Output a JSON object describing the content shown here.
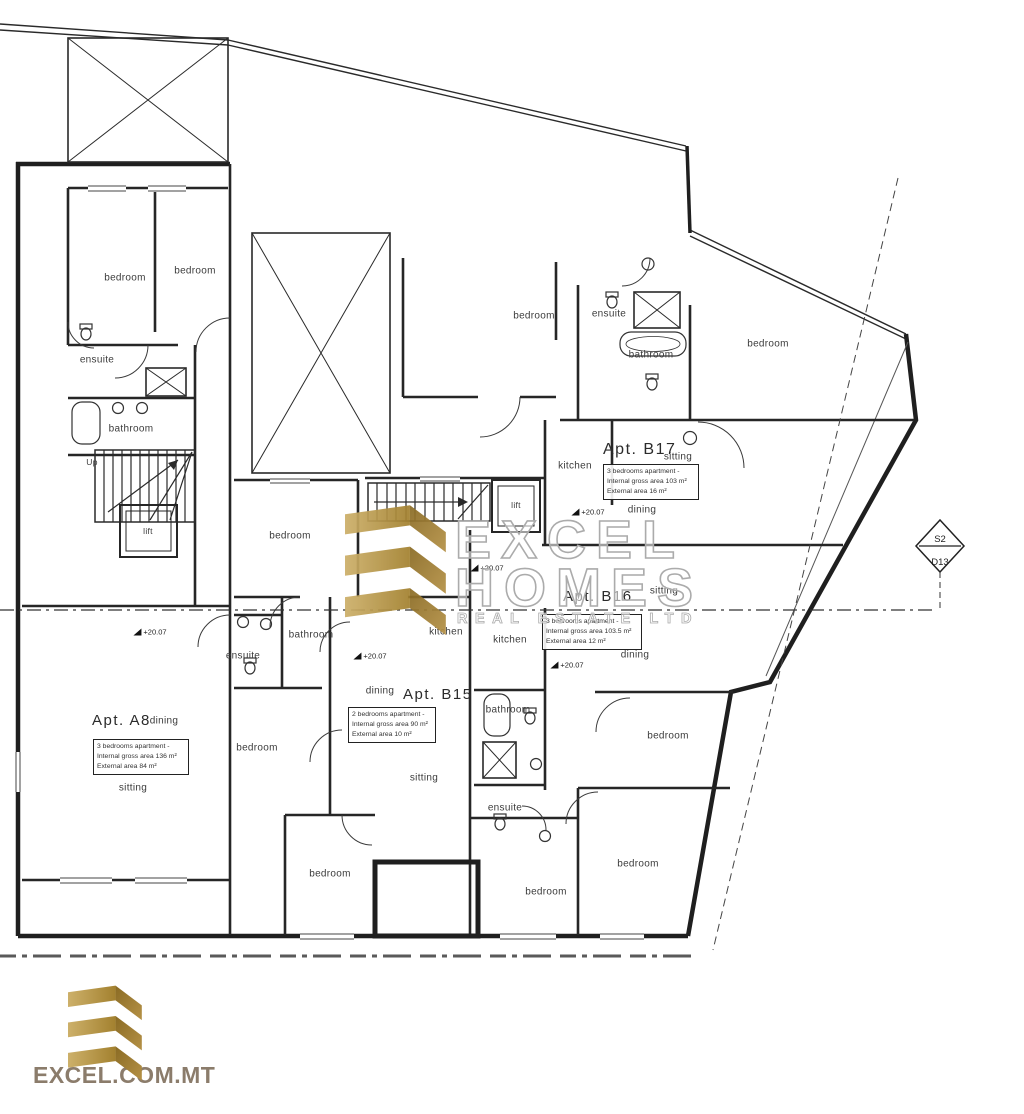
{
  "watermark": {
    "line1": "EXCEL",
    "line2": "HOMES",
    "line3": "REAL ESTATE LTD"
  },
  "footer": {
    "website": "EXCEL.COM.MT"
  },
  "plan": {
    "rooms": {
      "bedroom": "bedroom",
      "bathroom": "bathroom",
      "ensuite": "ensuite",
      "kitchen": "kitchen",
      "dining": "dining",
      "sitting": "sitting",
      "lift": "lift",
      "up": "Up"
    },
    "level_value": "+20.07",
    "section_marker": {
      "top": "S2",
      "bottom": "D13"
    },
    "apartments": {
      "a8": {
        "title": "Apt. A8",
        "lines": [
          "3 bedrooms apartment -",
          "Internal gross area 136 m²",
          "External area 84 m²"
        ]
      },
      "b15": {
        "title": "Apt. B15",
        "lines": [
          "2 bedrooms apartment -",
          "Internal gross area 90 m²",
          "External area 10 m²"
        ]
      },
      "b16": {
        "title": "Apt. B16",
        "lines": [
          "3 bedrooms apartment -",
          "Internal gross area 103.5 m²",
          "External area 12 m²"
        ]
      },
      "b17": {
        "title": "Apt. B17",
        "lines": [
          "3 bedrooms apartment -",
          "Internal gross area 103 m²",
          "External area 16 m²"
        ]
      }
    }
  },
  "colors": {
    "line": "#1f1f1f",
    "gold_light": "#cdb06a",
    "gold_dark": "#a3812f",
    "gold_fold_dark": "#8a6b24",
    "gold_fold_light": "#b59146",
    "footer_text": "#8b7c6b",
    "watermark_outline": "#ababab"
  }
}
